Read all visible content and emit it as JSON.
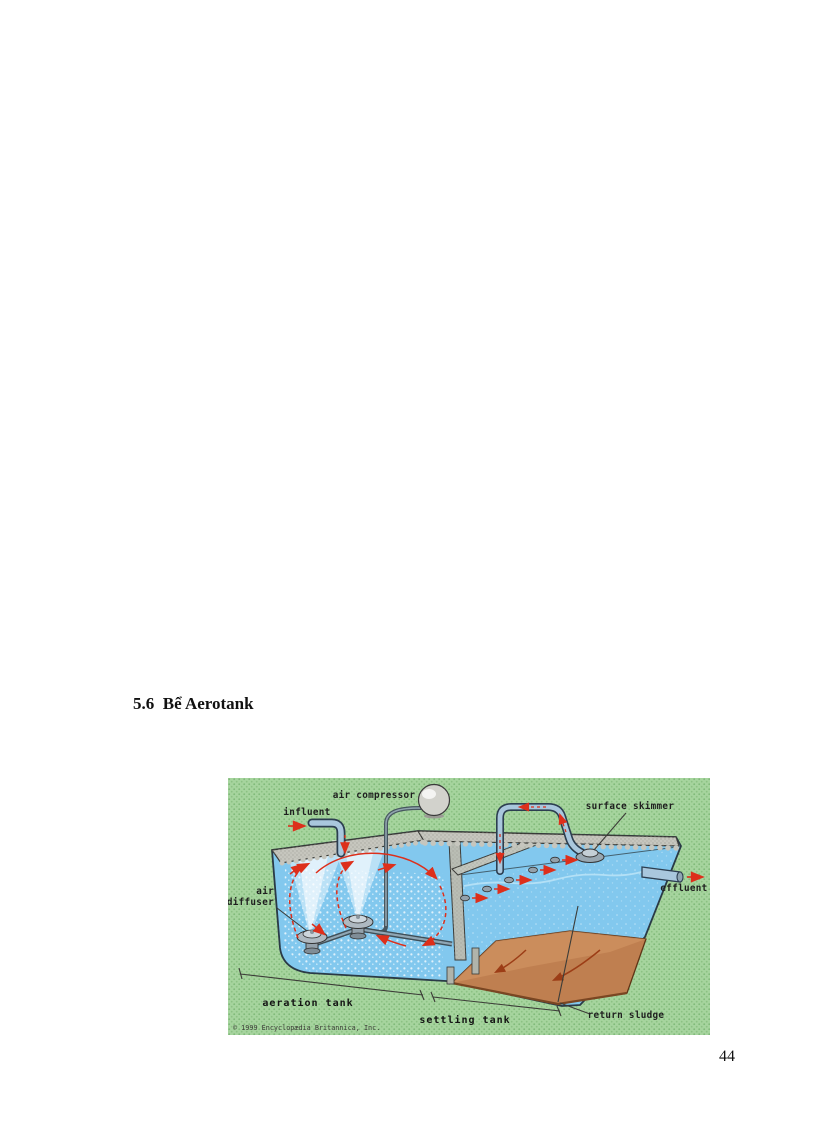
{
  "page": {
    "heading": "5.6  Bể Aerotank",
    "page_number": "44"
  },
  "figure": {
    "description": "Activated sludge process diagram: aeration tank and settling tank",
    "labels": {
      "air_compressor": "air compressor",
      "influent": "influent",
      "surface_skimmer": "surface skimmer",
      "air_diffuser_line1": "air",
      "air_diffuser_line2": "diffuser",
      "effluent": "effluent",
      "aeration_tank": "aeration tank",
      "settling_tank": "settling tank",
      "return_sludge": "return sludge",
      "copyright": "© 1999 Encyclopædia Britannica, Inc."
    },
    "colors": {
      "background_green": "#a6d49e",
      "water_blue": "#82c8ee",
      "rim_gray": "#c6c6be",
      "sludge_brown": "#bf7f50",
      "arrow_red": "#dd2f1b",
      "pipe_blue": "#a9c7dd",
      "label_text": "#1f1f1f"
    }
  }
}
